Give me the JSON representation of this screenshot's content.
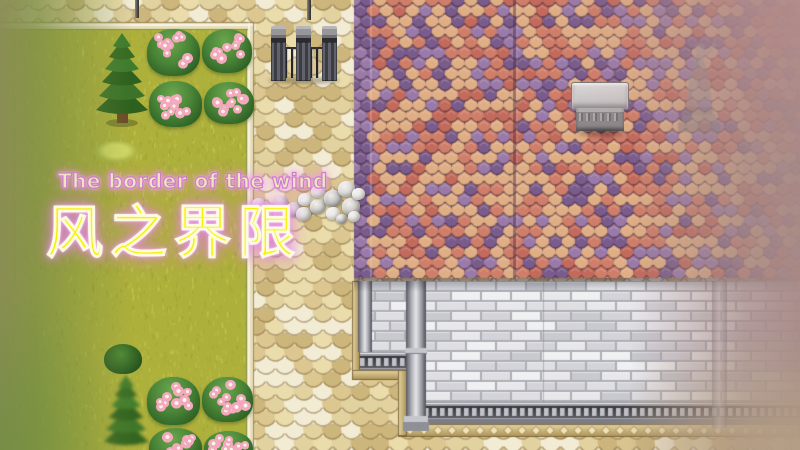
{
  "title": {
    "english": "The border of the wind",
    "chinese": "风之界限"
  },
  "scene": {
    "type": "rpg-title-screen",
    "areas": [
      "grass-field",
      "cobblestone-path",
      "shingled-roof",
      "stone-brick-wall"
    ],
    "sprites": [
      "pine-tree",
      "flower-bush",
      "shrub",
      "grass-tuft",
      "iron-gate",
      "stone-pile",
      "chimney",
      "statue",
      "lamp-post"
    ]
  },
  "palette": {
    "title_english_fill": "#efe6c0",
    "title_outline_pink": "#cf7cd0",
    "title_chinese_fill": "#f7f008",
    "glow_pink": "#e88ae2",
    "grass_base": "#aeb03c",
    "path_base": "#b79f6e",
    "roof_peach": "#dfae85",
    "roof_salmon": "#cf7e69",
    "roof_red": "#c26a5c",
    "roof_purple_light": "#9a7aa8",
    "roof_purple_dark": "#7a5c8c",
    "roof_gap": "#5a4150",
    "wall_mortar": "#aeaeb5",
    "molding_dark": "#3f3f45",
    "gold_trim": "#cdb77e",
    "stone_gray": "#cfcecb",
    "bush_green": "#3f7c33",
    "flower_pink": "#f2a8bd",
    "wash_left_green": "#7f8f48",
    "wash_right_mauve": "#a68a87"
  }
}
